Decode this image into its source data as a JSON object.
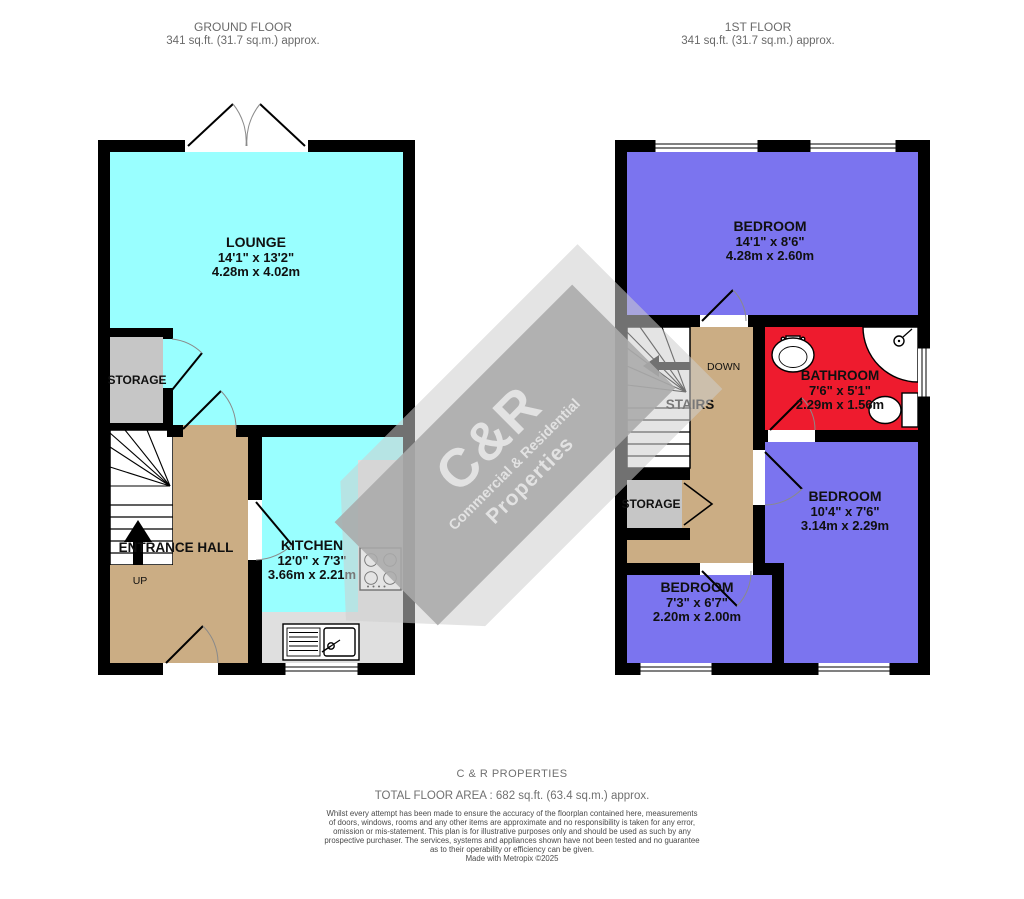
{
  "headers": {
    "ground": {
      "title": "GROUND FLOOR",
      "area": "341 sq.ft. (31.7 sq.m.) approx."
    },
    "first": {
      "title": "1ST FLOOR",
      "area": "341 sq.ft. (31.7 sq.m.) approx."
    }
  },
  "ground_floor": {
    "lounge": {
      "name": "LOUNGE",
      "imperial": "14'1\" x 13'2\"",
      "metric": "4.28m x 4.02m"
    },
    "storage": {
      "name": "STORAGE"
    },
    "entrance_hall": {
      "name": "ENTRANCE HALL",
      "direction": "UP"
    },
    "kitchen": {
      "name": "KITCHEN",
      "imperial": "12'0\" x 7'3\"",
      "metric": "3.66m x 2.21m"
    }
  },
  "first_floor": {
    "bedroom_front": {
      "name": "BEDROOM",
      "imperial": "14'1\" x 8'6\"",
      "metric": "4.28m x 2.60m"
    },
    "bathroom": {
      "name": "BATHROOM",
      "imperial": "7'6\" x 5'1\"",
      "metric": "2.29m x 1.56m"
    },
    "bedroom_rear": {
      "name": "BEDROOM",
      "imperial": "10'4\" x 7'6\"",
      "metric": "3.14m x 2.29m"
    },
    "bedroom_small": {
      "name": "BEDROOM",
      "imperial": "7'3\" x 6'7\"",
      "metric": "2.20m x 2.00m"
    },
    "storage": {
      "name": "STORAGE"
    },
    "stairs": {
      "name": "STAIRS",
      "direction": "DOWN"
    }
  },
  "watermark": {
    "logo": "C&R",
    "tagline": "Commercial & Residential",
    "brand": "Properties"
  },
  "footer": {
    "company": "C & R PROPERTIES",
    "total_area": "TOTAL FLOOR AREA : 682 sq.ft. (63.4 sq.m.) approx.",
    "disclaimer_lines": [
      "Whilst every attempt has been made to ensure the accuracy of the floorplan contained here, measurements",
      "of doors, windows, rooms and any other items are approximate and no responsibility is taken for any error,",
      "omission or mis-statement. This plan is for illustrative purposes only and should be used as such by any",
      "prospective purchaser. The services, systems and appliances shown have not been tested and no guarantee",
      "as to their operability or efficiency can be given."
    ],
    "credit": "Made with Metropix ©2025"
  },
  "colors": {
    "room_cyan": "#99FFFF",
    "room_purple": "#7B74EF",
    "room_red": "#EE1B2E",
    "hall_tan": "#CBAD84",
    "storage_grey": "#C6C6C6",
    "counter_grey": "#DFDFDF",
    "wall_black": "#000000",
    "stair_white": "#FFFFFF",
    "wm_band": "rgba(170,170,170,0.88)",
    "wm_text": "rgba(240,240,240,0.78)"
  }
}
